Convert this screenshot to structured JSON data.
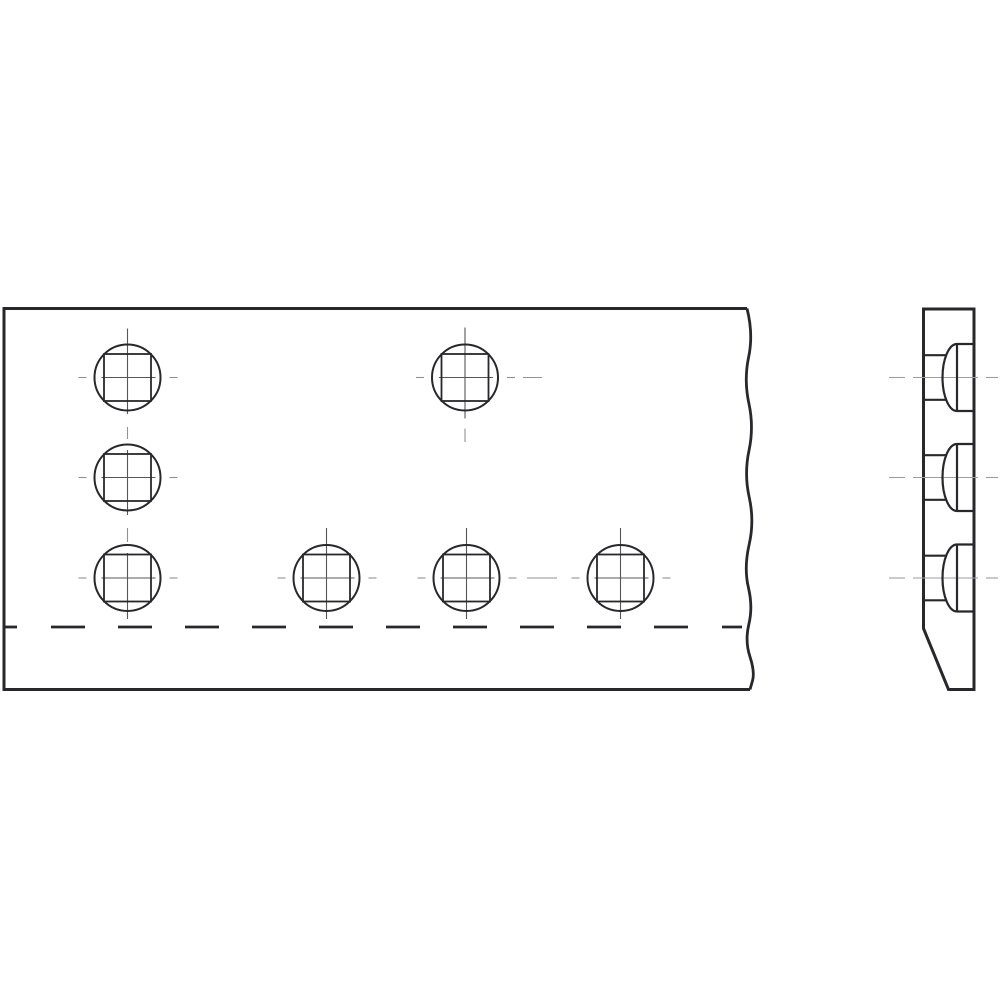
{
  "drawing": {
    "description": "Two-view technical drawing of a plate with square carriage-bolt holes and domed counterbores: front view (left, with break line) and side section view (right)",
    "canvas": {
      "width": 1000,
      "height": 1000,
      "background": "#ffffff"
    },
    "colors": {
      "ink": "#28282c",
      "centerline_dark": "#57575a",
      "centerline_light": "#929296",
      "side_centerline": "#9e9ea2"
    },
    "stroke_widths": {
      "front_outline": 3,
      "break_line": 2.8,
      "hidden_dash": 2.8,
      "hole_circle": 2,
      "square_hole": 1.8,
      "centerline": 1.1,
      "side_outline": 3,
      "side_profile": 2.2
    },
    "front_view": {
      "outline": {
        "left": 4,
        "top": 308.5,
        "bottom": 689.5,
        "top_right": 747,
        "bottom_right": 750
      },
      "break_line_points": [
        [
          747,
          308.5
        ],
        [
          753.5,
          334
        ],
        [
          743.8,
          380
        ],
        [
          754,
          427
        ],
        [
          744,
          474
        ],
        [
          754.5,
          521
        ],
        [
          743.8,
          568
        ],
        [
          753,
          607
        ],
        [
          744.8,
          641
        ],
        [
          755,
          672
        ],
        [
          750,
          689.5
        ]
      ],
      "hole_radius": 33,
      "square_half_side": 23.5,
      "holes": [
        {
          "cx": 127.5,
          "cy": 377.5,
          "vertical": "chain",
          "tail": false
        },
        {
          "cx": 465,
          "cy": 377.5,
          "vertical": "solo",
          "tail": true
        },
        {
          "cx": 127.5,
          "cy": 477.5,
          "vertical": "chain",
          "tail": false
        },
        {
          "cx": 127.5,
          "cy": 578,
          "vertical": "chain",
          "tail": false
        },
        {
          "cx": 326.5,
          "cy": 578,
          "vertical": "solo",
          "tail": false
        },
        {
          "cx": 466.5,
          "cy": 578,
          "vertical": "solo",
          "tail": false
        },
        {
          "cx": 620.5,
          "cy": 578,
          "vertical": "solo",
          "tail": false
        }
      ],
      "crosshair": {
        "h_short_left": [
          -49,
          -41
        ],
        "h_long": [
          -26,
          28
        ],
        "h_short_right": [
          42,
          50
        ],
        "v_solo": [
          -50,
          41
        ],
        "v_tail": [
          51,
          64.5
        ]
      },
      "column_centerline": {
        "x": 127.5,
        "segments": [
          {
            "y1": 328.5,
            "y2": 414,
            "shade": "dark"
          },
          {
            "y1": 427,
            "y2": 439,
            "shade": "light"
          },
          {
            "y1": 450,
            "y2": 515,
            "shade": "dark"
          },
          {
            "y1": 528,
            "y2": 542,
            "shade": "light"
          },
          {
            "y1": 553,
            "y2": 619,
            "shade": "dark"
          }
        ]
      },
      "extra_centerline_dashes": [
        {
          "y": 377.5,
          "x1": 523,
          "x2": 542
        },
        {
          "y": 578,
          "x1": 527,
          "x2": 557
        }
      ],
      "hidden_edge": {
        "y": 627,
        "dashes": [
          [
            4,
            17
          ],
          [
            51,
            85
          ],
          [
            118,
            152
          ],
          [
            185,
            219
          ],
          [
            252,
            286
          ],
          [
            319,
            353
          ],
          [
            386,
            420
          ],
          [
            453,
            487
          ],
          [
            520,
            554
          ],
          [
            587,
            621
          ],
          [
            654,
            688
          ],
          [
            722,
            742
          ]
        ]
      }
    },
    "side_view": {
      "outline": {
        "left": 923.5,
        "right": 974,
        "top": 309,
        "bottom": 689.5,
        "chamfer_top_y": 628.5,
        "chamfer_bottom_x": 948.5
      },
      "hole_profile": {
        "counterbore_x": 957,
        "counterbore_half_height": 33.5,
        "dome_rx": 14.5,
        "inner_half_height": 22.3,
        "inner_right_x": 946.2
      },
      "holes": [
        {
          "cy": 377.5
        },
        {
          "cy": 477.5
        },
        {
          "cy": 578
        }
      ],
      "centerline_dashes": [
        [
          889,
          905
        ],
        [
          913,
          978
        ],
        [
          986,
          998
        ]
      ]
    }
  }
}
